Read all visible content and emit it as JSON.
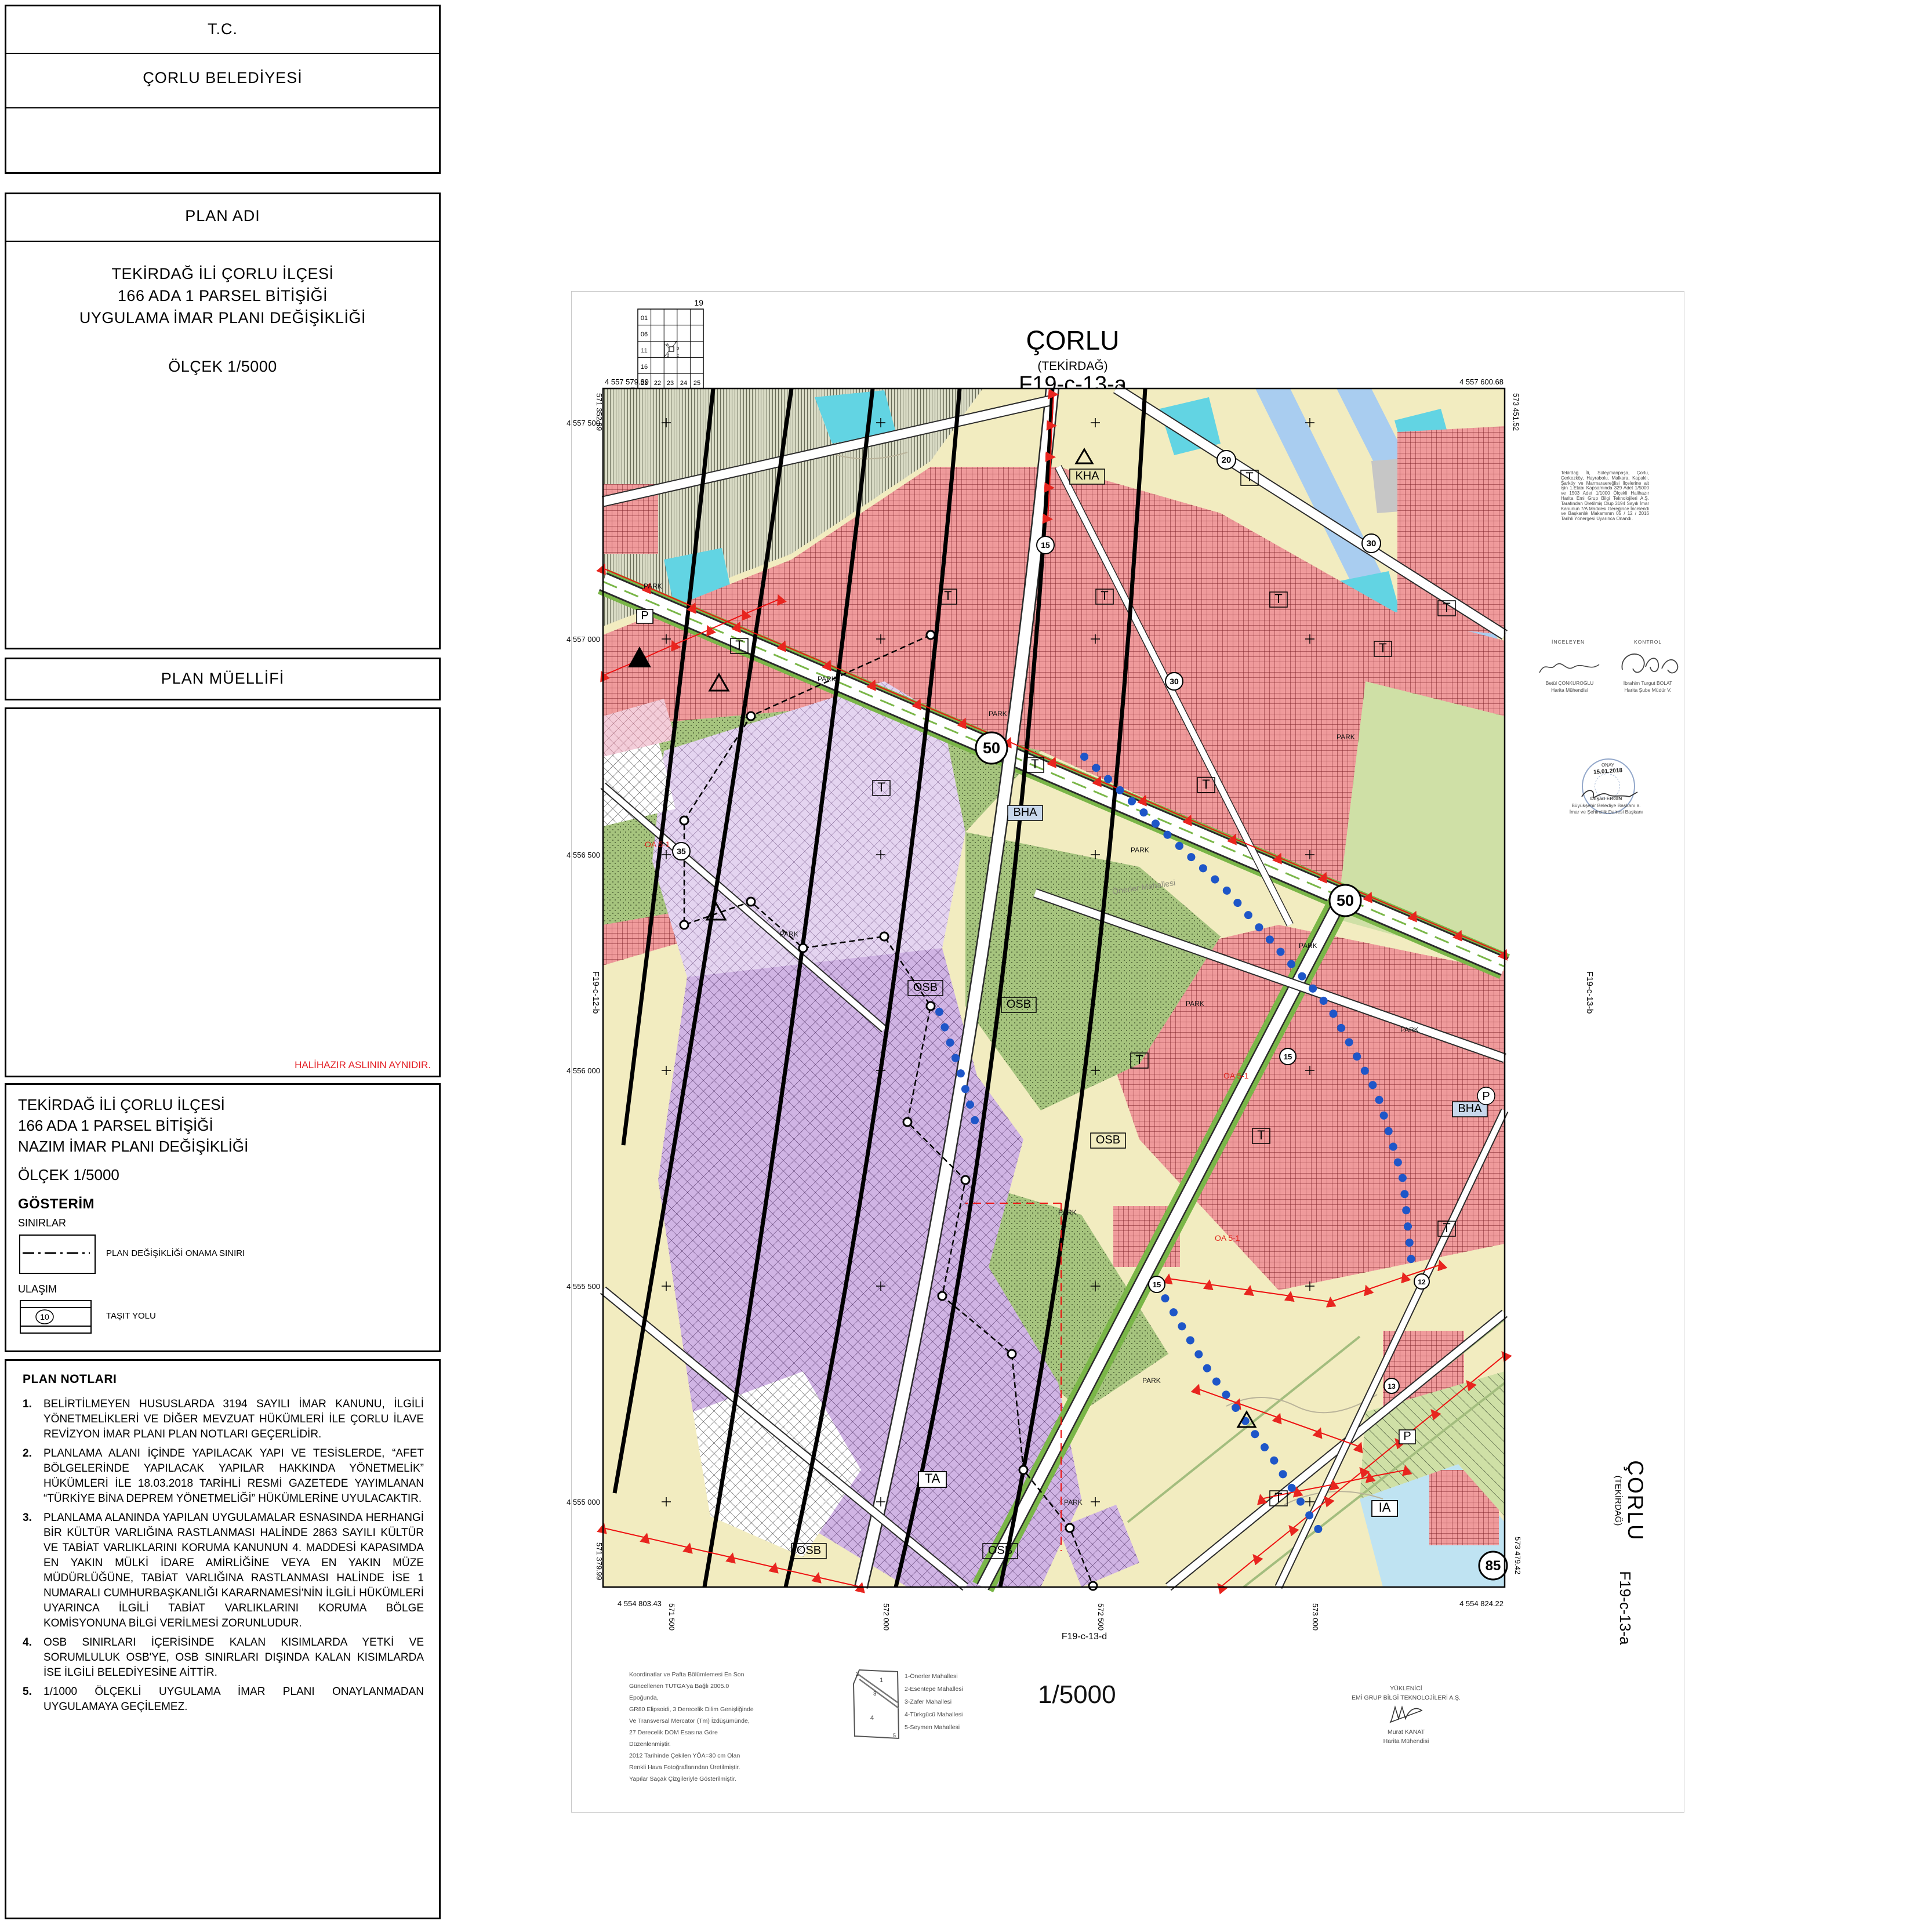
{
  "titleblock": {
    "tc": "T.C.",
    "municipality": "ÇORLU BELEDİYESİ",
    "plan_adi_header": "PLAN ADI",
    "plan_adi_line1": "TEKİRDAĞ İLİ ÇORLU İLÇESİ",
    "plan_adi_line2": "166 ADA 1 PARSEL BİTİŞİĞİ",
    "plan_adi_line3": "UYGULAMA İMAR PLANI DEĞİŞİKLİĞİ",
    "plan_adi_scale": "ÖLÇEK 1/5000",
    "plan_muellifi_header": "PLAN MÜELLİFİ",
    "halihazir_note": "HALİHAZIR ASLININ AYNIDIR."
  },
  "nazim_block": {
    "line1": "TEKİRDAĞ İLİ ÇORLU İLÇESİ",
    "line2": "166 ADA 1 PARSEL BİTİŞİĞİ",
    "line3": "NAZIM İMAR PLANI DEĞİŞİKLİĞİ",
    "scale": "ÖLÇEK 1/5000",
    "gosterim": "GÖSTERİM",
    "sinirlar": "SINIRLAR",
    "onama_label": "PLAN DEĞİŞİKLİĞİ ONAMA SINIRI",
    "ulasim": "ULAŞIM",
    "tasit_label": "TAŞIT YOLU",
    "tasit_no": "10"
  },
  "plan_notlari": {
    "header": "PLAN NOTLARI",
    "items": [
      {
        "no": "1.",
        "text": "BELİRTİLMEYEN HUSUSLARDA 3194 SAYILI İMAR KANUNU, İLGİLİ YÖNETMELİKLERİ VE DİĞER MEVZUAT HÜKÜMLERİ İLE ÇORLU İLAVE REVİZYON İMAR PLANI PLAN NOTLARI GEÇERLİDİR."
      },
      {
        "no": "2.",
        "text": "PLANLAMA ALANI İÇİNDE YAPILACAK YAPI VE TESİSLERDE, “AFET BÖLGELERİNDE YAPILACAK YAPILAR HAKKINDA YÖNETMELİK” HÜKÜMLERİ İLE 18.03.2018 TARİHLİ RESMİ GAZETEDE YAYIMLANAN “TÜRKİYE BİNA DEPREM YÖNETMELİĞİ” HÜKÜMLERİNE UYULACAKTIR."
      },
      {
        "no": "3.",
        "text": "PLANLAMA ALANINDA YAPILAN UYGULAMALAR ESNASINDA HERHANGİ BİR KÜLTÜR VARLIĞINA RASTLANMASI HALİNDE 2863 SAYILI KÜLTÜR VE TABİAT VARLIKLARINI KORUMA KANUNUN 4. MADDESİ KAPASIMDA EN YAKIN MÜLKİ İDARE AMİRLİĞİNE VEYA EN YAKIN MÜZE MÜDÜRLÜĞÜNE, TABİAT VARLIĞINA RASTLANMASI HALİNDE İSE 1 NUMARALI CUMHURBAŞKANLIĞI KARARNAMESİ'NİN İLGİLİ HÜKÜMLERİ UYARINCA İLGİLİ TABİAT VARLIKLARINI KORUMA BÖLGE KOMİSYONUNA BİLGİ VERİLMESİ ZORUNLUDUR."
      },
      {
        "no": "4.",
        "text": "OSB SINIRLARI İÇERİSİNDE KALAN KISIMLARDA YETKİ VE SORUMLULUK OSB'YE, OSB SINIRLARI DIŞINDA KALAN KISIMLARDA İSE İLGİLİ BELEDİYESİNE AİTTİR."
      },
      {
        "no": "5.",
        "text": "1/1000 ÖLÇEKLİ UYGULAMA İMAR PLANI ONAYLANMADAN UYGULAMAYA GEÇİLEMEZ."
      }
    ]
  },
  "map": {
    "title_city": "ÇORLU",
    "title_prov": "(TEKİRDAĞ)",
    "title_sheet": "F19-c-13-a",
    "adj_top": "F19-c-08-d",
    "adj_left": "F19-c-12-b",
    "adj_right": "F19-c-13-b",
    "adj_bottom": "F19-c-13-d",
    "corner_tl_n": "4 557 579.89",
    "corner_tl_e": "571 352.89",
    "corner_tr_n": "4 557 600.68",
    "corner_tr_e": "573 451.52",
    "corner_bl_n": "4 554 803.43",
    "corner_bl_e": "571 379.99",
    "corner_br_n": "4 554 824.22",
    "corner_br_e": "573 479.42",
    "grid_n": [
      "4 557 500",
      "4 557 000",
      "4 556 500",
      "4 556 000",
      "4 555 500",
      "4 555 000"
    ],
    "grid_e": [
      "571 500",
      "572 000",
      "572 500",
      "573 000"
    ],
    "index": {
      "sheet_no": "19",
      "row_letter": "F",
      "col": [
        "01",
        "06",
        "11",
        "16",
        "21"
      ],
      "row": [
        "22",
        "23",
        "24",
        "25"
      ],
      "qa": "a",
      "qb": "b",
      "qc": "c",
      "qd": "d"
    },
    "roads": [
      {
        "n": "20"
      },
      {
        "n": "30"
      },
      {
        "n": "15"
      },
      {
        "n": "30"
      },
      {
        "n": "50"
      },
      {
        "n": "50"
      },
      {
        "n": "35"
      },
      {
        "n": "15"
      },
      {
        "n": "15"
      },
      {
        "n": "12"
      },
      {
        "n": "13"
      },
      {
        "n": "85"
      }
    ],
    "zones": {
      "t": "T",
      "osb": "OSB",
      "park": "PARK",
      "bha": "BHA",
      "kha": "KHA",
      "ta": "TA",
      "ia": "IA",
      "p": "P",
      "oa": "OA 5-1",
      "mahalle": "Önerler Mahallesi"
    }
  },
  "approval": {
    "paragraph": "Tekirdağ İli, Süleymanpaşa, Çorlu, Çerkezköy, Hayrabolu, Malkara, Kapaklı, Şarköy ve Marmaraereğlisi İlçelerine ait işin 1.Etabı Kapsamında 329 Adet 1/5000 ve 1503 Adet 1/1000 Ölçekli Halihazır Harita Emi Grup Bilgi Teknolojileri A.Ş. Tarafından Üretilmiş Olup 3194 Sayılı İmar Kanunun 7/A Maddesi Gereğince İncelendi ve Başkanlık Makamının 05 / 12 / 2016 Tarihli Yönergesi Uyarınca Onandı.",
    "inceleyen_label": "İNCELEYEN",
    "kontrol_label": "KONTROL",
    "inceleyen_name": "Betül ÇONKUROĞLU",
    "inceleyen_title": "Harita Mühendisi",
    "kontrol_name": "İbrahim Turgut BOLAT",
    "kontrol_title": "Harita Şube Müdür V.",
    "onay_label": "ONAY",
    "onay_date": "15.01.2018",
    "onay_name": "Dilşad ERGİN",
    "onay_title1": "Büyükşehir Belediye Başkanı a.",
    "onay_title2": "İmar ve Şehircilik Dairesi Başkanı"
  },
  "margin": {
    "city_vertical": "ÇORLU",
    "prov_vertical": "(TEKİRDAĞ)",
    "sheet_vertical": "F19-c-13-a"
  },
  "footer": {
    "datum_note": "Koordinatlar ve Pafta Bölümlemesi En Son\nGüncellenen TUTGA'ya Bağlı 2005.0 Epoğunda,\nGR80 Elipsoidi, 3 Derecelik Dilim Genişliğinde\nVe Transversal Mercator (Tm) İzdüşümünde,\n27 Derecelik DOM Esasına Göre Düzenlenmiştir.\n2012 Tarihinde Çekilen YÖA=30 cm Olan\nRenkli Hava Fotoğraflarından Üretilmiştir.\nYapılar Saçak Çizgileriyle Gösterilmiştir.",
    "mahalleler": [
      "1-Önerler Mahallesi",
      "2-Esentepe Mahallesi",
      "3-Zafer Mahallesi",
      "4-Türkgücü Mahallesi",
      "5-Seymen Mahallesi"
    ],
    "sketch_nums": [
      "1",
      "2",
      "3",
      "4",
      "5"
    ],
    "scale_big": "1/5000",
    "yuklenici_label": "YÜKLENİCİ",
    "yuklenici_firm": "EMİ GRUP BİLGİ TEKNOLOJİLERİ A.Ş.",
    "yuklenici_name": "Murat KANAT",
    "yuklenici_title": "Harita Mühendisi"
  },
  "colors": {
    "accent_red": "#e31e24",
    "stamp_blue": "#7d9cc4",
    "osb_purple": "#d0b4e4",
    "zone_red": "#ef9a9b",
    "park_green": "#a6c47e",
    "water_cyan": "#62d4e3",
    "road_strip_blue": "#a9cdf0"
  }
}
